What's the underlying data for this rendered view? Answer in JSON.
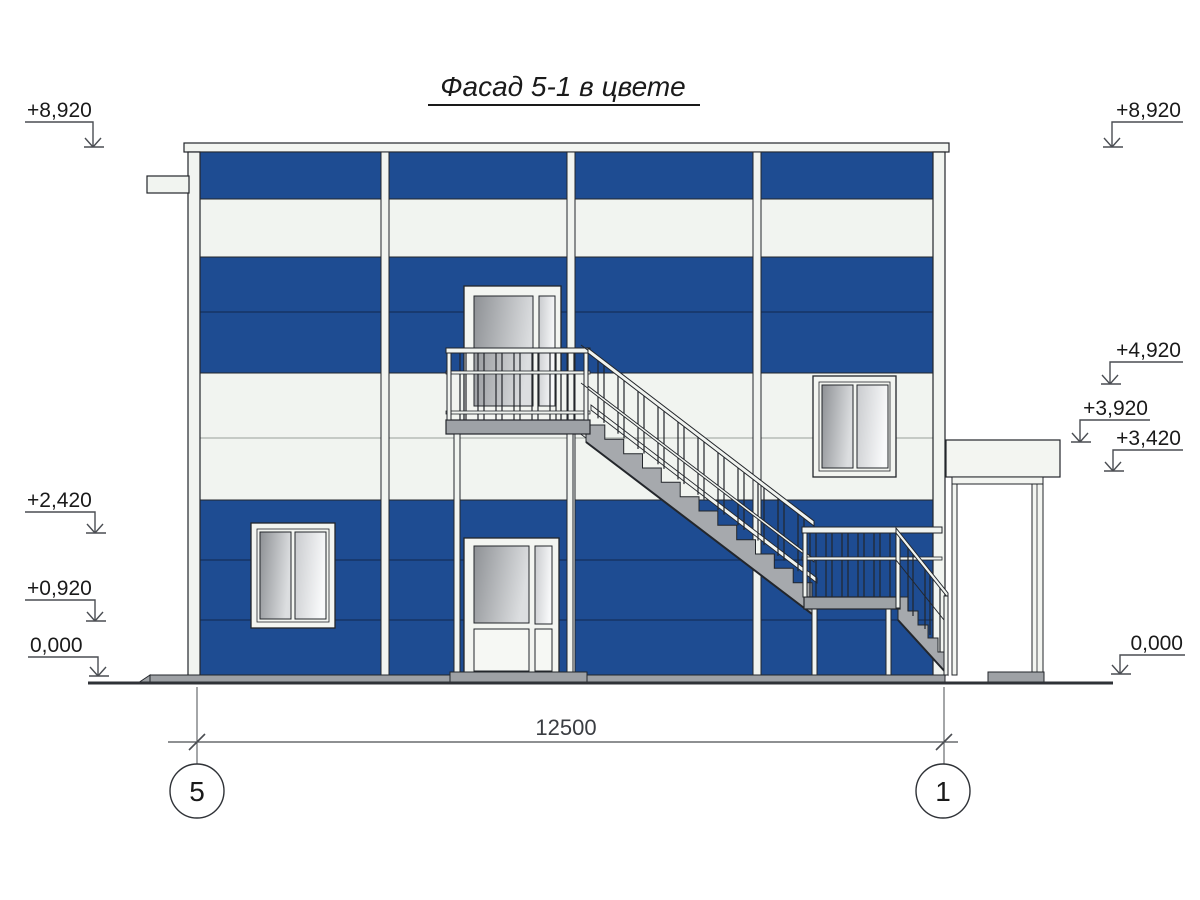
{
  "title": "Фасад 5-1 в цвете",
  "elevation_marks": {
    "left": [
      "+8,920",
      "+2,420",
      "+0,920",
      "0,000"
    ],
    "right": [
      "+8,920",
      "+4,920",
      "+3,920",
      "+3,420",
      "0,000"
    ]
  },
  "dimension": {
    "overall_width_mm": "12500"
  },
  "axes": {
    "left": "5",
    "right": "1"
  },
  "colors": {
    "facade_blue": "#1E4C92",
    "panel_white": "#F1F4F0",
    "metal_gray": "#A6A9AD",
    "outline": "#23262B"
  }
}
